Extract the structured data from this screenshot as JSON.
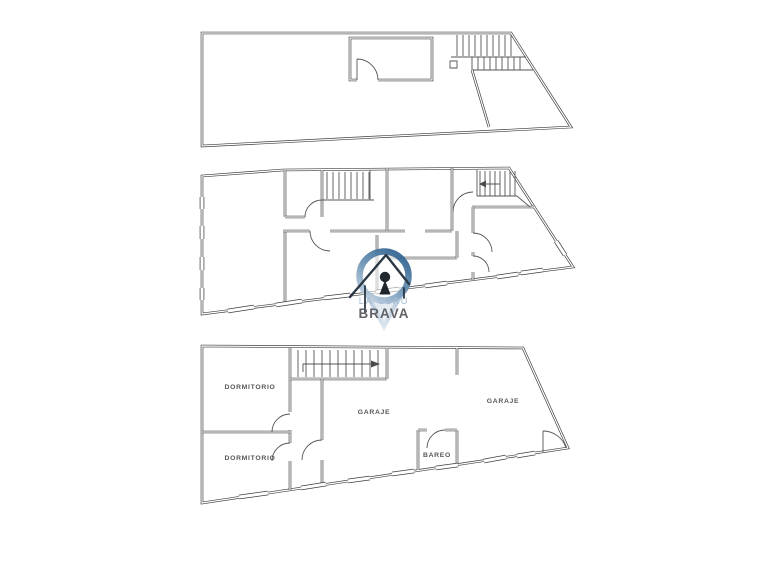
{
  "canvas": {
    "background": "#ffffff",
    "line_color": "#3d3d3d"
  },
  "plans": {
    "bottom": {
      "rooms": [
        {
          "label": "DORMITORIO"
        },
        {
          "label": "DORMITORIO"
        },
        {
          "label": "GARAJE"
        },
        {
          "label": "GARAJE"
        },
        {
          "label": "BAREO"
        }
      ]
    }
  },
  "watermark": {
    "brand_line1": "LA CLAU",
    "brand_line2": "BRAVA",
    "ring_dark": "#2b5e8c",
    "ring_mid": "#6e96b8",
    "ring_light": "#c2d2e1",
    "tail_top": "#a9bfd4",
    "tail_tip": "#dde7f0",
    "house_outline": "#1d2a38",
    "keyhole_color": "#101820",
    "line1_color": "#9db7cf",
    "line2_color": "#55575c"
  }
}
